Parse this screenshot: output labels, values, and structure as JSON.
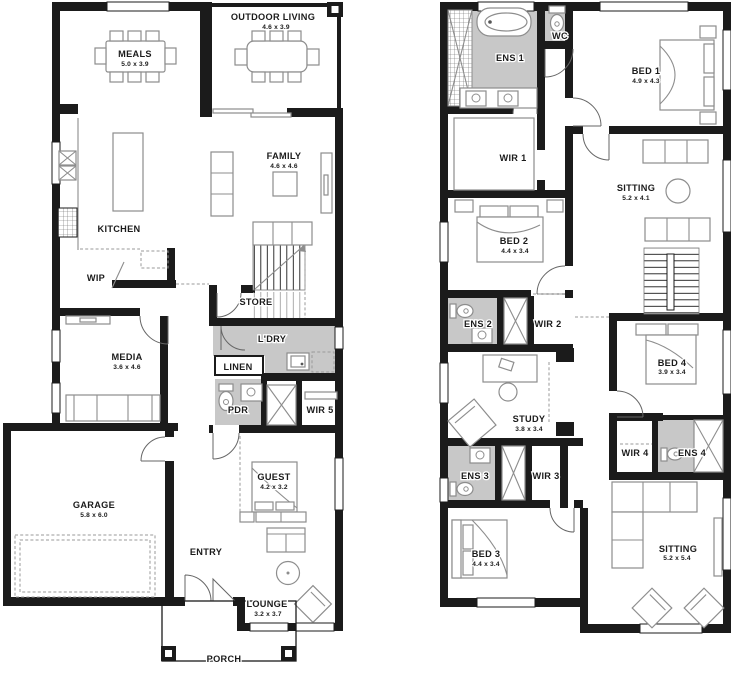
{
  "ground_floor": {
    "rooms": [
      {
        "label": "MEALS",
        "dims": "5.0 x 3.9"
      },
      {
        "label": "OUTDOOR LIVING",
        "dims": "4.6 x 3.9"
      },
      {
        "label": "FAMILY",
        "dims": "4.6 x 4.6"
      },
      {
        "label": "KITCHEN"
      },
      {
        "label": "WIP"
      },
      {
        "label": "STORE"
      },
      {
        "label": "L'DRY"
      },
      {
        "label": "LINEN"
      },
      {
        "label": "MEDIA",
        "dims": "3.6 x 4.6"
      },
      {
        "label": "PDR"
      },
      {
        "label": "WIR 5"
      },
      {
        "label": "GARAGE",
        "dims": "5.8 x 6.0"
      },
      {
        "label": "ENTRY"
      },
      {
        "label": "GUEST",
        "dims": "4.2 x 3.2"
      },
      {
        "label": "LOUNGE",
        "dims": "3.2 x 3.7"
      },
      {
        "label": "PORCH"
      }
    ]
  },
  "upper_floor": {
    "rooms": [
      {
        "label": "ENS 1"
      },
      {
        "label": "WC"
      },
      {
        "label": "BED 1",
        "dims": "4.9 x 4.3"
      },
      {
        "label": "WIR 1"
      },
      {
        "label": "SITTING",
        "dims": "5.2 x 4.1"
      },
      {
        "label": "BED 2",
        "dims": "4.4 x 3.4"
      },
      {
        "label": "ENS 2"
      },
      {
        "label": "WIR 2"
      },
      {
        "label": "STUDY",
        "dims": "3.8 x 3.4"
      },
      {
        "label": "BED 4",
        "dims": "3.9 x 3.4"
      },
      {
        "label": "WIR 4"
      },
      {
        "label": "ENS 4"
      },
      {
        "label": "ENS 3"
      },
      {
        "label": "WIR 3"
      },
      {
        "label": "BED 3",
        "dims": "4.4 x 3.4"
      },
      {
        "label": "SITTING",
        "dims": "5.2 x 5.4"
      }
    ]
  },
  "colors": {
    "wall": "#1b1b1b",
    "wet_area": "#c8c8c8",
    "furniture_line": "#8d8d8d"
  }
}
